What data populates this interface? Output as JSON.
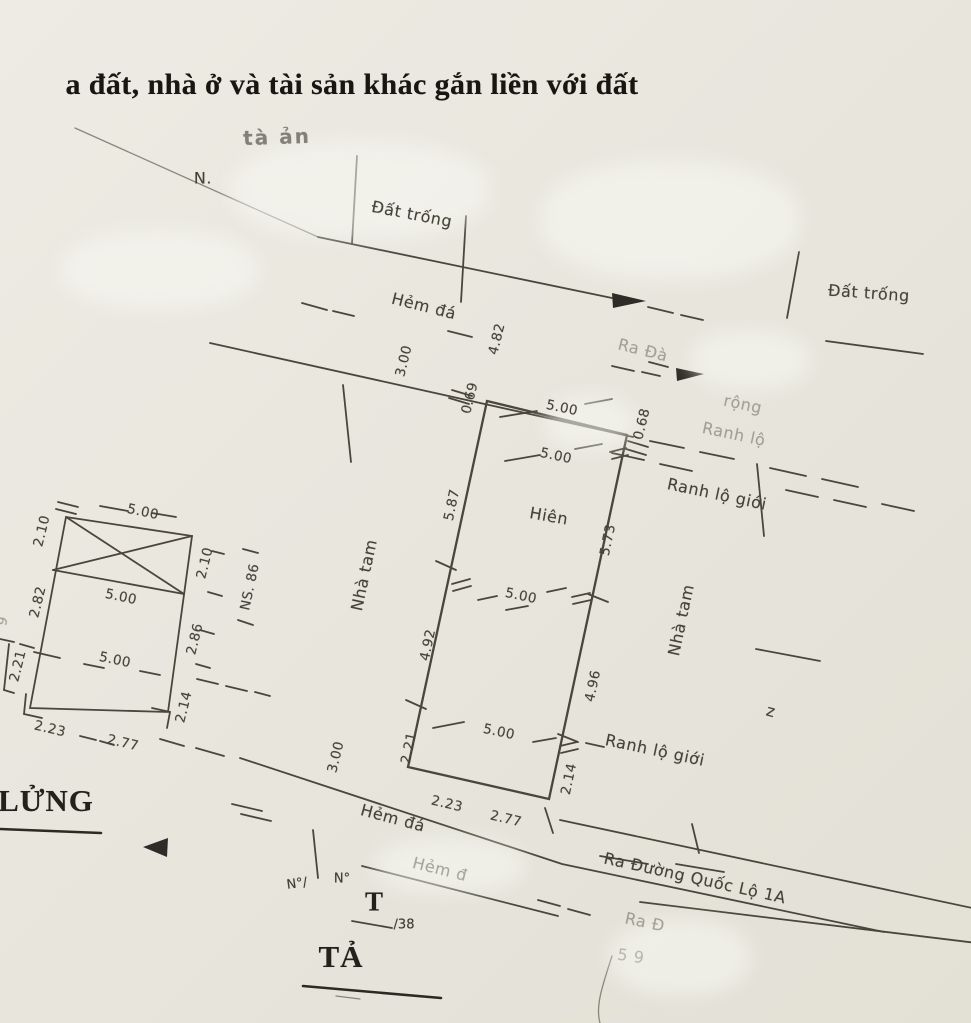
{
  "colors": {
    "paper": "#e8e6dd",
    "ink": "#4a463b",
    "text": "#403d33"
  },
  "document": {
    "type_note": "scanned cadastral sketch - land parcel, house and assets attached to land"
  },
  "labels": [
    {
      "n": "doc-title-fragment",
      "t": "a đất, nhà ở và tài sản khác gắn liền với đất",
      "x": 352,
      "y": 85,
      "r": 0,
      "c": "title"
    },
    {
      "n": "faded-note",
      "t": "tà ản",
      "x": 277,
      "y": 137,
      "r": -2,
      "c": "faded-bold"
    },
    {
      "n": "north-mark",
      "t": "N.",
      "x": 203,
      "y": 178,
      "r": 0,
      "c": "lbl"
    },
    {
      "n": "dat-trong-top",
      "t": "Đất trống",
      "x": 412,
      "y": 214,
      "r": 11,
      "c": "lbl"
    },
    {
      "n": "dat-trong-right",
      "t": "Đất trống",
      "x": 869,
      "y": 293,
      "r": 4,
      "c": "lbl"
    },
    {
      "n": "hem-da-top",
      "t": "Hẻm đá",
      "x": 424,
      "y": 306,
      "r": 14,
      "c": "lbl"
    },
    {
      "n": "ra-da-faded",
      "t": "Ra Đà",
      "x": 643,
      "y": 350,
      "r": 14,
      "c": "lbl faded"
    },
    {
      "n": "rong-faded",
      "t": "rộng",
      "x": 743,
      "y": 404,
      "r": 12,
      "c": "lbl faded"
    },
    {
      "n": "ranh-lo-faded",
      "t": "Ranh lộ",
      "x": 734,
      "y": 434,
      "r": 12,
      "c": "lbl faded"
    },
    {
      "n": "ranh-lo-gioi-upper",
      "t": "Ranh lộ giới",
      "x": 717,
      "y": 494,
      "r": 12,
      "c": "lbl"
    },
    {
      "n": "hien-label",
      "t": "Hiên",
      "x": 549,
      "y": 516,
      "r": 10,
      "c": "lbl"
    },
    {
      "n": "nha-tam-left",
      "t": "Nhà tam",
      "x": 364,
      "y": 575,
      "r": -78,
      "c": "lbl"
    },
    {
      "n": "nha-tam-right",
      "t": "Nhà tam",
      "x": 681,
      "y": 620,
      "r": -78,
      "c": "lbl"
    },
    {
      "n": "ranh-lo-gioi-lower",
      "t": "Ranh lộ giới",
      "x": 655,
      "y": 750,
      "r": 12,
      "c": "lbl"
    },
    {
      "n": "z-mark",
      "t": "z",
      "x": 771,
      "y": 711,
      "r": 15,
      "c": "lbl"
    },
    {
      "n": "hem-da-bottom",
      "t": "Hẻm đá",
      "x": 393,
      "y": 818,
      "r": 15,
      "c": "lbl"
    },
    {
      "n": "hem-da-bottom-2",
      "t": "Hẻm đ",
      "x": 440,
      "y": 869,
      "r": 14,
      "c": "lbl faded"
    },
    {
      "n": "ra-duong-quoc-lo",
      "t": "Ra Đường Quốc Lộ 1A",
      "x": 695,
      "y": 878,
      "r": 12.5,
      "c": "lbl"
    },
    {
      "n": "ra-d-faded",
      "t": "Ra Đ",
      "x": 645,
      "y": 922,
      "r": 12,
      "c": "lbl faded"
    },
    {
      "n": "no-mark-1",
      "t": "N°/",
      "x": 297,
      "y": 884,
      "r": -8,
      "c": "sm"
    },
    {
      "n": "no-mark-2",
      "t": "N°",
      "x": 342,
      "y": 879,
      "r": 0,
      "c": "sm"
    },
    {
      "n": "t-mark",
      "t": "T",
      "x": 374,
      "y": 902,
      "r": 0,
      "c": "serif-md"
    },
    {
      "n": "t-sub",
      "t": "/38",
      "x": 404,
      "y": 925,
      "r": 0,
      "c": "sm"
    },
    {
      "n": "ta-mark",
      "t": "TẢ",
      "x": 341,
      "y": 957,
      "r": 0,
      "c": "serif-big"
    },
    {
      "n": "lung-mark",
      "t": "LỬNG",
      "x": 46,
      "y": 801,
      "r": 0,
      "c": "serif-big"
    },
    {
      "n": "faint-59",
      "t": "5 9",
      "x": 631,
      "y": 956,
      "r": 8,
      "c": "lbl faded2"
    },
    {
      "n": "left-edge-partial",
      "t": "9",
      "x": 3,
      "y": 621,
      "r": -76,
      "c": "dim faded"
    },
    {
      "n": "dim-hem-width-top",
      "t": "3.00",
      "x": 404,
      "y": 361,
      "r": -76,
      "c": "dim"
    },
    {
      "n": "dim-4-82",
      "t": "4.82",
      "x": 497,
      "y": 339,
      "r": -76,
      "c": "dim"
    },
    {
      "n": "dim-0-69",
      "t": "0.69",
      "x": 470,
      "y": 398,
      "r": -76,
      "c": "dim"
    },
    {
      "n": "dim-front-5-00-a",
      "t": "5.00",
      "x": 562,
      "y": 408,
      "r": 12,
      "c": "dim"
    },
    {
      "n": "dim-front-5-00-b",
      "t": "5.00",
      "x": 556,
      "y": 456,
      "r": 12,
      "c": "dim"
    },
    {
      "n": "dim-0-68",
      "t": "0.68",
      "x": 642,
      "y": 424,
      "r": -76,
      "c": "dim"
    },
    {
      "n": "dim-5-87",
      "t": "5.87",
      "x": 452,
      "y": 505,
      "r": -78,
      "c": "dim"
    },
    {
      "n": "dim-5-73",
      "t": "5.73",
      "x": 608,
      "y": 540,
      "r": -78,
      "c": "dim"
    },
    {
      "n": "dim-mid-5-00",
      "t": "5.00",
      "x": 521,
      "y": 596,
      "r": 12,
      "c": "dim"
    },
    {
      "n": "dim-4-92",
      "t": "4.92",
      "x": 428,
      "y": 645,
      "r": -78,
      "c": "dim"
    },
    {
      "n": "dim-4-96",
      "t": "4.96",
      "x": 593,
      "y": 686,
      "r": -78,
      "c": "dim"
    },
    {
      "n": "dim-hem-width-bot",
      "t": "3.00",
      "x": 336,
      "y": 757,
      "r": -76,
      "c": "dim"
    },
    {
      "n": "dim-2-21",
      "t": "2.21",
      "x": 409,
      "y": 748,
      "r": -78,
      "c": "dim"
    },
    {
      "n": "dim-2-14",
      "t": "2.14",
      "x": 569,
      "y": 779,
      "r": -78,
      "c": "dim"
    },
    {
      "n": "dim-bottom-5-00",
      "t": "5.00",
      "x": 499,
      "y": 732,
      "r": 12,
      "c": "dim"
    },
    {
      "n": "dim-2-23",
      "t": "2.23",
      "x": 447,
      "y": 804,
      "r": 13,
      "c": "dim"
    },
    {
      "n": "dim-2-77",
      "t": "2.77",
      "x": 506,
      "y": 819,
      "r": 13,
      "c": "dim"
    },
    {
      "n": "sub-dim-2-10-left",
      "t": "2.10",
      "x": 42,
      "y": 531,
      "r": -76,
      "c": "dim"
    },
    {
      "n": "sub-dim-5-00-top",
      "t": "5.00",
      "x": 143,
      "y": 512,
      "r": 12,
      "c": "dim"
    },
    {
      "n": "sub-dim-5-00-mid",
      "t": "5.00",
      "x": 121,
      "y": 597,
      "r": 12,
      "c": "dim"
    },
    {
      "n": "sub-dim-2-82",
      "t": "2.82",
      "x": 38,
      "y": 602,
      "r": -76,
      "c": "dim"
    },
    {
      "n": "sub-dim-2-10-right",
      "t": "2.10",
      "x": 205,
      "y": 563,
      "r": -76,
      "c": "dim"
    },
    {
      "n": "sub-label-ns-86",
      "t": "NS. 86",
      "x": 250,
      "y": 587,
      "r": -78,
      "c": "dim"
    },
    {
      "n": "sub-dim-2-86",
      "t": "2.86",
      "x": 195,
      "y": 639,
      "r": -76,
      "c": "dim"
    },
    {
      "n": "sub-dim-2-21",
      "t": "2.21",
      "x": 18,
      "y": 666,
      "r": -76,
      "c": "dim"
    },
    {
      "n": "sub-dim-5-00-bot",
      "t": "5.00",
      "x": 115,
      "y": 660,
      "r": 12,
      "c": "dim"
    },
    {
      "n": "sub-dim-2-14",
      "t": "2.14",
      "x": 184,
      "y": 707,
      "r": -76,
      "c": "dim"
    },
    {
      "n": "sub-dim-2-23",
      "t": "2.23",
      "x": 50,
      "y": 729,
      "r": 13,
      "c": "dim"
    },
    {
      "n": "sub-dim-2-77",
      "t": "2.77",
      "x": 123,
      "y": 743,
      "r": 13,
      "c": "dim"
    }
  ]
}
